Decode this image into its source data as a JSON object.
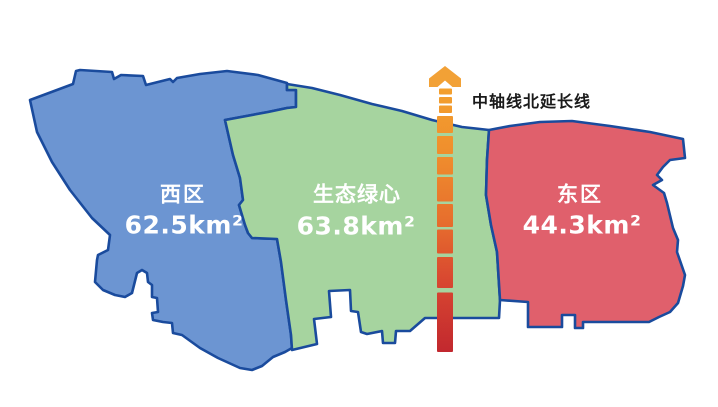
{
  "regions": {
    "west": {
      "name": "西区",
      "area": "62.5km²",
      "fill": "#6C95D2"
    },
    "green_heart": {
      "name": "生态绿心",
      "area": "63.8km²",
      "fill": "#A6D49F"
    },
    "east": {
      "name": "东区",
      "area": "44.3km²",
      "fill": "#E0606C"
    }
  },
  "axis": {
    "label": "中轴线北延长线",
    "arrow_color": "#F2A136",
    "gradient": [
      "#F3A02E",
      "#EF8E2D",
      "#E76F2D",
      "#D94930",
      "#C2282F"
    ],
    "label_color": "#1A1A1A"
  },
  "map": {
    "border_color": "#1A4B9D",
    "background": "#FFFFFF",
    "label_text_color": "#FFFFFF"
  }
}
